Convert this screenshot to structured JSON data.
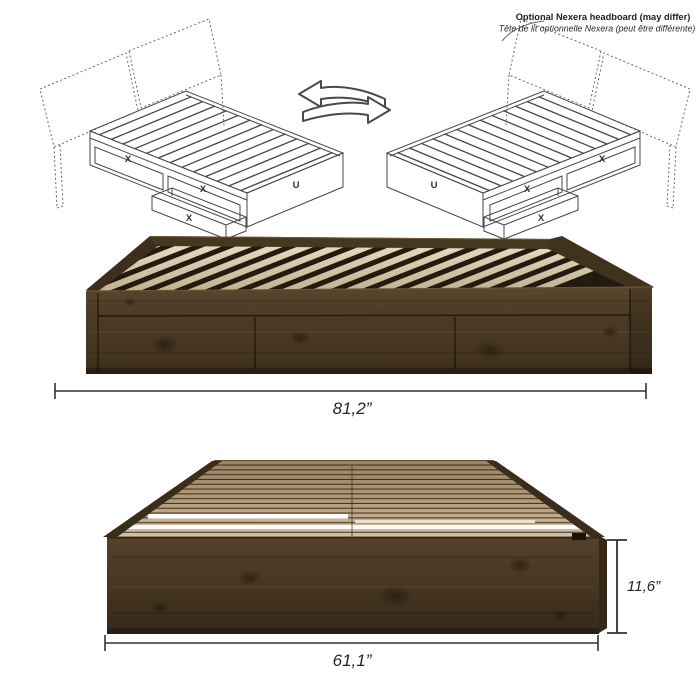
{
  "annotation": {
    "title": "Optional Nexera headboard (may differ)",
    "subtitle": "Tête de lit optionnelle Nexera (peut être différente)"
  },
  "diagram_left": {
    "drawer_labels": [
      "X",
      "X",
      "X"
    ],
    "underbed_label": "U"
  },
  "diagram_right": {
    "drawer_labels": [
      "X",
      "X",
      "X"
    ],
    "underbed_label": "U"
  },
  "dimensions": {
    "length": "81,2”",
    "width": "61,1”",
    "height": "11,6”"
  },
  "colors": {
    "wood_dark": "#4a3826",
    "wood_mid": "#5d4a30",
    "slat_light": "#d9c9ae",
    "slat_tan": "#b79d7b",
    "line_art": "#474747",
    "dimension_line": "#333333"
  }
}
